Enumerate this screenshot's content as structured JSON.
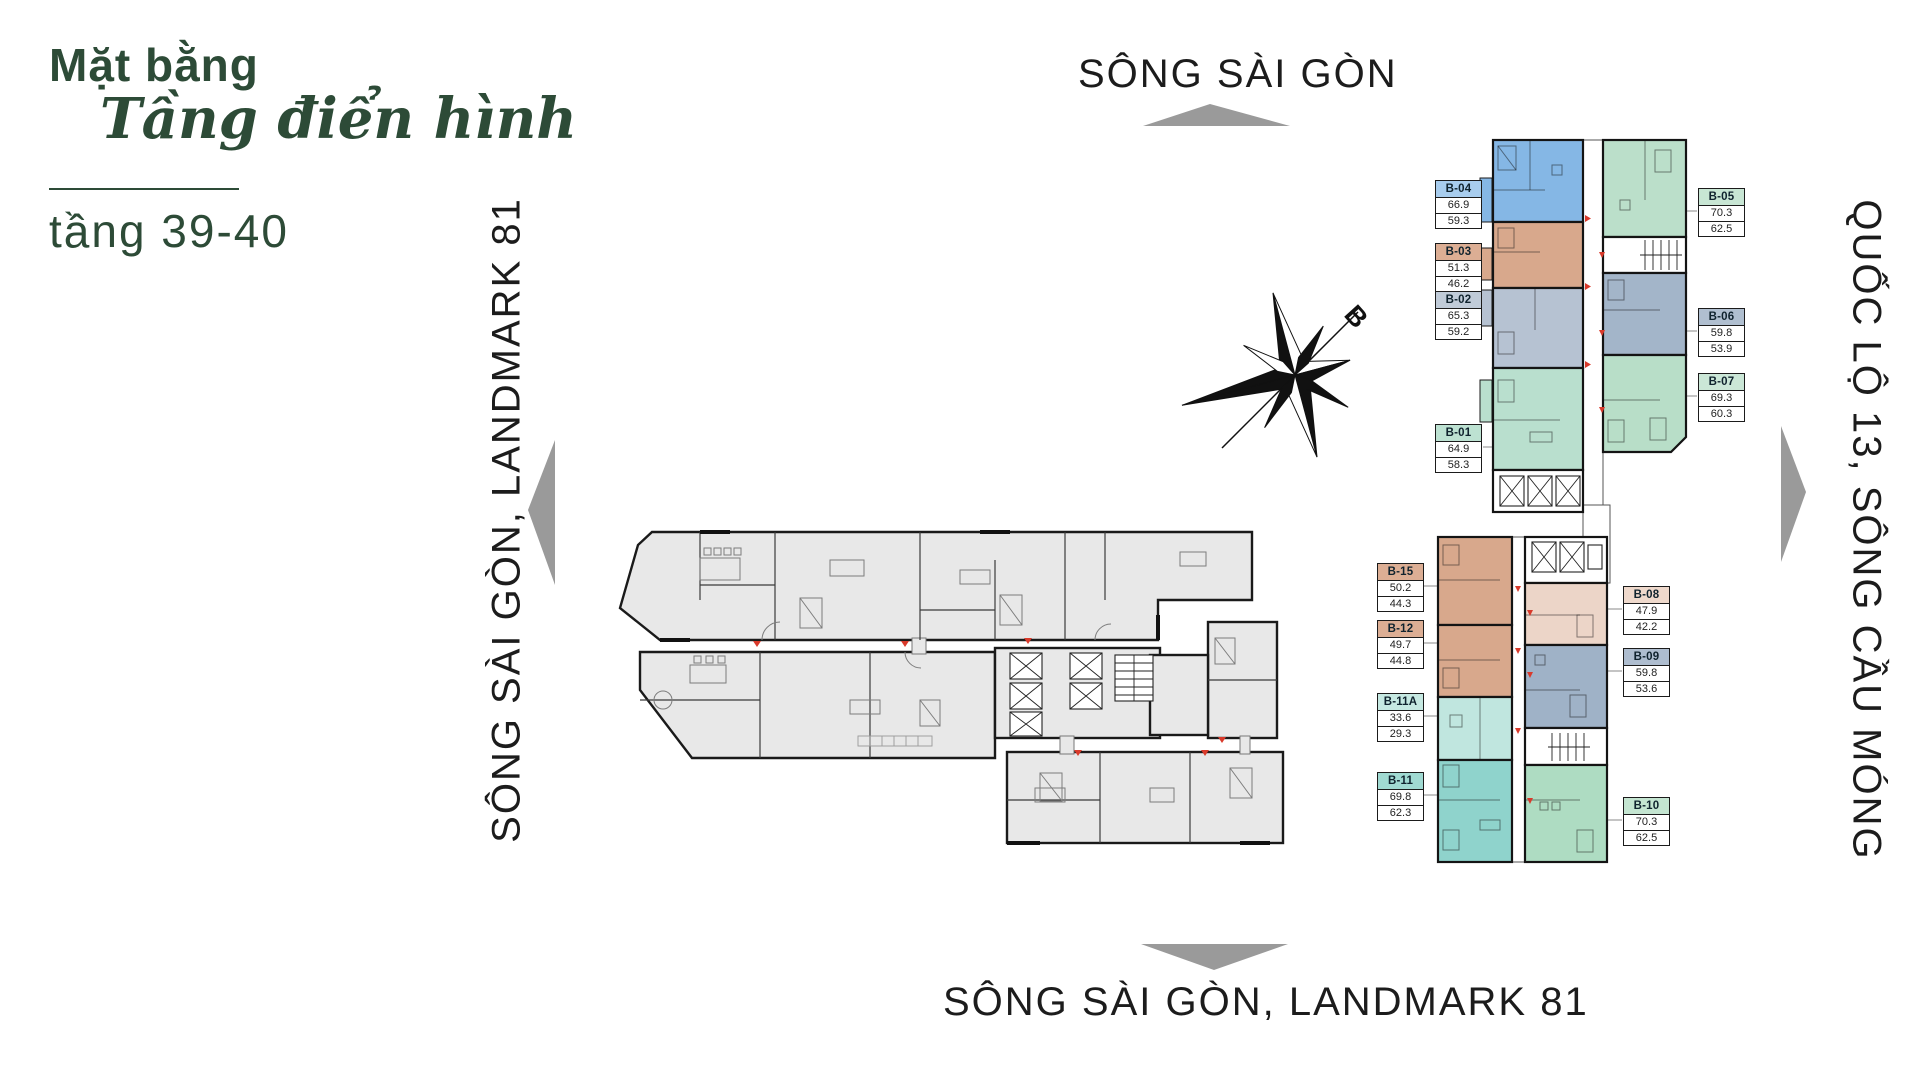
{
  "title": {
    "line1": "Mặt bằng",
    "line2": "Tầng điển hình",
    "line3": "tầng 39-40"
  },
  "directions": {
    "top": "SÔNG SÀI GÒN",
    "bottom": "SÔNG SÀI GÒN, LANDMARK 81",
    "left": "SÔNG SÀI GÒN, LANDMARK 81",
    "right": "QUỐC LỘ 13, SÔNG CẦU MÓNG"
  },
  "compass": {
    "label": "B"
  },
  "colors": {
    "title_green": "#2d4b37",
    "arrow_gray": "#9a9a9a",
    "plan_gray": "#e8e8e8",
    "wall_dark": "#1a1a1a",
    "marker_red": "#d93a2b"
  },
  "units": [
    {
      "id": "B-04",
      "area1": "66.9",
      "area2": "59.3",
      "fill": "#85b7e5",
      "header": "#a8cdee"
    },
    {
      "id": "B-03",
      "area1": "51.3",
      "area2": "46.2",
      "fill": "#d8a88c",
      "header": "#dcae94"
    },
    {
      "id": "B-02",
      "area1": "65.3",
      "area2": "59.2",
      "fill": "#b6c2d2",
      "header": "#c0cbd8"
    },
    {
      "id": "B-01",
      "area1": "64.9",
      "area2": "58.3",
      "fill": "#b9dfce",
      "header": "#bde2d2"
    },
    {
      "id": "B-05",
      "area1": "70.3",
      "area2": "62.5",
      "fill": "#bbdfca",
      "header": "#c8e6d4"
    },
    {
      "id": "B-06",
      "area1": "59.8",
      "area2": "53.9",
      "fill": "#a3b5c9",
      "header": "#b0bfd0"
    },
    {
      "id": "B-07",
      "area1": "69.3",
      "area2": "60.3",
      "fill": "#b8dec8",
      "header": "#cbe7d7"
    },
    {
      "id": "B-15",
      "area1": "50.2",
      "area2": "44.3",
      "fill": "#d8a88c",
      "header": "#dcae94"
    },
    {
      "id": "B-12",
      "area1": "49.7",
      "area2": "44.8",
      "fill": "#d8a88c",
      "header": "#dcae94"
    },
    {
      "id": "B-11A",
      "area1": "33.6",
      "area2": "29.3",
      "fill": "#c0e6df",
      "header": "#c6e9e2"
    },
    {
      "id": "B-11",
      "area1": "69.8",
      "area2": "62.3",
      "fill": "#8fd3cc",
      "header": "#a0dad2"
    },
    {
      "id": "B-08",
      "area1": "47.9",
      "area2": "42.2",
      "fill": "#ecd5c8",
      "header": "#efd9cc"
    },
    {
      "id": "B-09",
      "area1": "59.8",
      "area2": "53.6",
      "fill": "#9fb2c7",
      "header": "#aebdcf"
    },
    {
      "id": "B-10",
      "area1": "70.3",
      "area2": "62.5",
      "fill": "#aedcc2",
      "header": "#c4e5d1"
    }
  ]
}
